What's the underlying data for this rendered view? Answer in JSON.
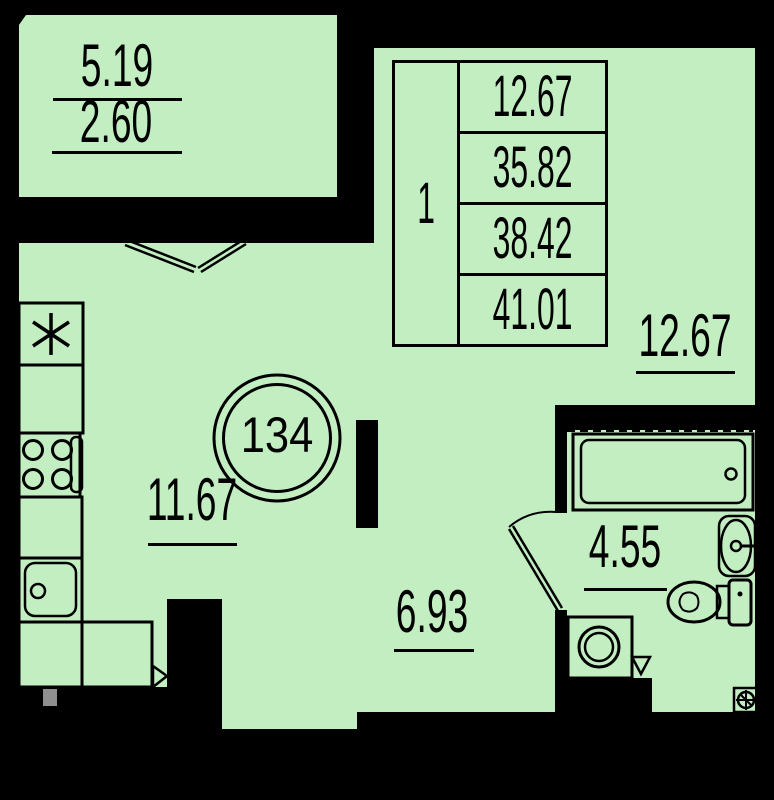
{
  "floor_plan": {
    "apartment_number": "134",
    "balcony": {
      "area_total": "5.19",
      "area_counted": "2.60"
    },
    "summary_table": {
      "rooms_count": "1",
      "values": [
        "12.67",
        "35.82",
        "38.42",
        "41.01"
      ]
    },
    "room_areas": {
      "living_room": "12.67",
      "kitchen": "11.67",
      "hallway": "6.93",
      "bathroom": "4.55"
    },
    "colors": {
      "floor_fill": "#c2eec2",
      "wall": "#000000",
      "pipe_gray": "#8f8f8f"
    },
    "fixtures": [
      "ventilation-asterisk",
      "kitchen-counters",
      "stove",
      "kitchen-sink",
      "bathtub",
      "wash-basin",
      "toilet",
      "washing-machine",
      "floor-drain",
      "pipe-riser",
      "balcony-double-door",
      "bathroom-door"
    ]
  }
}
